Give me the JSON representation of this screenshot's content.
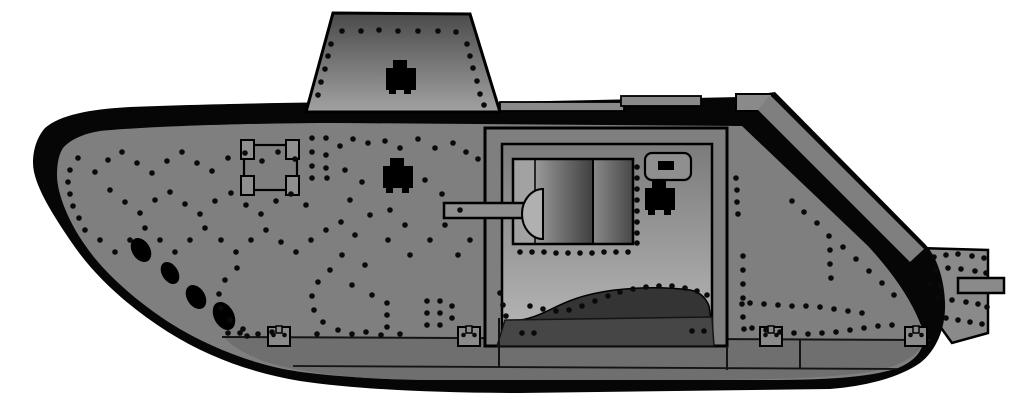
{
  "illustration": {
    "alt": "Side profile illustration of a World War One heavy tank with riveted armour plates, raised driver's cab, side sponson mounting a short gun, mud chutes and a full-length caterpillar track",
    "subject": "WWI heavy tank, left side view",
    "style": "flat vector drawing with rivet detail"
  },
  "canvas": {
    "width": 1024,
    "height": 410
  },
  "colors": {
    "background": "#ffffff",
    "outline": "#000000",
    "track": "#060606",
    "hull": "#7f7f7f",
    "hull_lower": "#6f6f6f",
    "roof": "#8a8a8a",
    "tail": "#8a8a8a",
    "cab_top": "#4a4a4a",
    "cab_bottom": "#a2a2a2",
    "sponson_top": "#7b7b7b",
    "sponson_bottom": "#b8b8b8",
    "gunbox_strip": "#a2a2a2",
    "gunbox_light": "#9a9a9a",
    "gunbox_dark": "#3f3f3f",
    "gunbox_right_light": "#8a8a8a",
    "gunbox_right_dark": "#474747",
    "barrel": "#8f8f8f",
    "mantlet": "#b0b0b0",
    "port": "#8f8f8f",
    "shadow": "#343434",
    "skirt_band": "#464646",
    "seam": "#141414",
    "rivet": "#0a0a0a",
    "detail": "#000000"
  },
  "rivet_radius": 2.8,
  "rivets": [
    [
      342,
      31
    ],
    [
      361,
      31
    ],
    [
      379,
      30
    ],
    [
      398,
      31
    ],
    [
      418,
      31
    ],
    [
      438,
      31
    ],
    [
      456,
      32
    ],
    [
      331,
      44
    ],
    [
      328,
      56
    ],
    [
      325,
      69
    ],
    [
      321,
      82
    ],
    [
      318,
      95
    ],
    [
      467,
      44
    ],
    [
      470,
      56
    ],
    [
      473,
      68
    ],
    [
      477,
      81
    ],
    [
      480,
      94
    ],
    [
      484,
      105
    ],
    [
      312,
      138
    ],
    [
      326,
      138
    ],
    [
      312,
      152
    ],
    [
      326,
      155
    ],
    [
      312,
      166
    ],
    [
      326,
      168
    ],
    [
      312,
      178
    ],
    [
      327,
      178
    ],
    [
      340,
      146
    ],
    [
      353,
      139
    ],
    [
      368,
      143
    ],
    [
      385,
      141
    ],
    [
      400,
      148
    ],
    [
      418,
      139
    ],
    [
      435,
      148
    ],
    [
      453,
      143
    ],
    [
      466,
      152
    ],
    [
      478,
      159
    ],
    [
      78,
      158
    ],
    [
      70,
      170
    ],
    [
      68,
      182
    ],
    [
      70,
      194
    ],
    [
      73,
      206
    ],
    [
      79,
      218
    ],
    [
      85,
      230
    ],
    [
      95,
      172
    ],
    [
      108,
      160
    ],
    [
      122,
      152
    ],
    [
      137,
      163
    ],
    [
      152,
      173
    ],
    [
      167,
      161
    ],
    [
      182,
      152
    ],
    [
      197,
      163
    ],
    [
      212,
      171
    ],
    [
      228,
      158
    ],
    [
      245,
      153
    ],
    [
      262,
      161
    ],
    [
      278,
      152
    ],
    [
      295,
      159
    ],
    [
      110,
      190
    ],
    [
      125,
      202
    ],
    [
      140,
      213
    ],
    [
      155,
      200
    ],
    [
      170,
      192
    ],
    [
      185,
      204
    ],
    [
      200,
      214
    ],
    [
      215,
      201
    ],
    [
      231,
      193
    ],
    [
      246,
      205
    ],
    [
      261,
      214
    ],
    [
      276,
      201
    ],
    [
      291,
      194
    ],
    [
      306,
      205
    ],
    [
      100,
      240
    ],
    [
      115,
      252
    ],
    [
      130,
      240
    ],
    [
      145,
      228
    ],
    [
      160,
      240
    ],
    [
      175,
      252
    ],
    [
      190,
      240
    ],
    [
      205,
      228
    ],
    [
      221,
      240
    ],
    [
      236,
      252
    ],
    [
      251,
      240
    ],
    [
      266,
      230
    ],
    [
      281,
      242
    ],
    [
      296,
      252
    ],
    [
      311,
      240
    ],
    [
      326,
      230
    ],
    [
      341,
      222
    ],
    [
      345,
      170
    ],
    [
      362,
      182
    ],
    [
      350,
      200
    ],
    [
      370,
      215
    ],
    [
      355,
      235
    ],
    [
      342,
      255
    ],
    [
      365,
      265
    ],
    [
      390,
      210
    ],
    [
      405,
      225
    ],
    [
      388,
      240
    ],
    [
      410,
      255
    ],
    [
      430,
      240
    ],
    [
      445,
      225
    ],
    [
      460,
      210
    ],
    [
      442,
      194
    ],
    [
      425,
      180
    ],
    [
      458,
      255
    ],
    [
      470,
      240
    ],
    [
      352,
      285
    ],
    [
      372,
      295
    ],
    [
      237,
      268
    ],
    [
      225,
      280
    ],
    [
      219,
      294
    ],
    [
      221,
      308
    ],
    [
      230,
      320
    ],
    [
      243,
      329
    ],
    [
      258,
      334
    ],
    [
      272,
      332
    ],
    [
      330,
      270
    ],
    [
      318,
      282
    ],
    [
      312,
      296
    ],
    [
      314,
      310
    ],
    [
      323,
      322
    ],
    [
      338,
      330
    ],
    [
      352,
      334
    ],
    [
      366,
      332
    ],
    [
      381,
      335
    ],
    [
      247,
      336
    ],
    [
      387,
      303
    ],
    [
      387,
      315
    ],
    [
      387,
      327
    ],
    [
      427,
      301
    ],
    [
      440,
      301
    ],
    [
      427,
      313
    ],
    [
      440,
      313
    ],
    [
      427,
      325
    ],
    [
      440,
      325
    ],
    [
      452,
      306
    ],
    [
      452,
      318
    ],
    [
      228,
      333
    ],
    [
      240,
      333
    ],
    [
      317,
      334
    ],
    [
      400,
      334
    ],
    [
      736,
      178
    ],
    [
      737,
      190
    ],
    [
      737,
      202
    ],
    [
      738,
      214
    ],
    [
      792,
      201
    ],
    [
      804,
      212
    ],
    [
      817,
      223
    ],
    [
      829,
      236
    ],
    [
      830,
      250
    ],
    [
      830,
      264
    ],
    [
      831,
      278
    ],
    [
      843,
      247
    ],
    [
      856,
      259
    ],
    [
      869,
      271
    ],
    [
      882,
      283
    ],
    [
      894,
      295
    ],
    [
      750,
      303
    ],
    [
      764,
      304
    ],
    [
      778,
      305
    ],
    [
      792,
      306
    ],
    [
      806,
      306
    ],
    [
      820,
      307
    ],
    [
      834,
      309
    ],
    [
      848,
      311
    ],
    [
      862,
      313
    ],
    [
      752,
      328
    ],
    [
      766,
      330
    ],
    [
      780,
      332
    ],
    [
      794,
      333
    ],
    [
      808,
      334
    ],
    [
      822,
      333
    ],
    [
      836,
      332
    ],
    [
      850,
      330
    ],
    [
      864,
      328
    ],
    [
      878,
      326
    ],
    [
      892,
      325
    ],
    [
      743,
      256
    ],
    [
      743,
      270
    ],
    [
      743,
      284
    ],
    [
      743,
      298
    ],
    [
      934,
      257
    ],
    [
      946,
      255
    ],
    [
      958,
      254
    ],
    [
      972,
      256
    ],
    [
      984,
      258
    ],
    [
      936,
      270
    ],
    [
      948,
      268
    ],
    [
      961,
      269
    ],
    [
      975,
      271
    ],
    [
      986,
      273
    ],
    [
      930,
      284
    ],
    [
      940,
      286
    ],
    [
      938,
      298
    ],
    [
      952,
      300
    ],
    [
      966,
      302
    ],
    [
      978,
      304
    ],
    [
      987,
      307
    ],
    [
      946,
      318
    ],
    [
      958,
      320
    ],
    [
      970,
      322
    ],
    [
      982,
      324
    ],
    [
      637,
      167
    ],
    [
      637,
      178
    ],
    [
      637,
      189
    ],
    [
      637,
      200
    ],
    [
      637,
      211
    ],
    [
      637,
      222
    ],
    [
      637,
      233
    ],
    [
      637,
      243
    ],
    [
      520,
      252
    ],
    [
      532,
      252
    ],
    [
      544,
      252
    ],
    [
      556,
      253
    ],
    [
      568,
      253
    ],
    [
      580,
      253
    ],
    [
      592,
      253
    ],
    [
      604,
      252
    ],
    [
      616,
      252
    ],
    [
      628,
      252
    ],
    [
      530,
      306
    ],
    [
      543,
      309
    ],
    [
      556,
      311
    ],
    [
      569,
      310
    ],
    [
      582,
      306
    ],
    [
      595,
      301
    ],
    [
      608,
      296
    ],
    [
      620,
      292
    ],
    [
      633,
      289
    ],
    [
      646,
      287
    ],
    [
      659,
      286
    ],
    [
      672,
      286
    ],
    [
      685,
      288
    ],
    [
      697,
      291
    ],
    [
      707,
      295
    ],
    [
      500,
      293
    ],
    [
      503,
      305
    ],
    [
      506,
      316
    ],
    [
      522,
      333
    ],
    [
      534,
      333
    ],
    [
      692,
      331
    ],
    [
      704,
      331
    ],
    [
      742,
      304
    ],
    [
      743,
      317
    ],
    [
      744,
      329
    ]
  ],
  "mud_chutes": [
    {
      "cx": 141,
      "cy": 250,
      "rx": 9,
      "ry": 13,
      "angle": -32
    },
    {
      "cx": 170,
      "cy": 273,
      "rx": 8,
      "ry": 12,
      "angle": -32
    },
    {
      "cx": 196,
      "cy": 297,
      "rx": 9,
      "ry": 13,
      "angle": -32
    },
    {
      "cx": 224,
      "cy": 316,
      "rx": 10,
      "ry": 15,
      "angle": -28
    }
  ],
  "track_brackets": {
    "y": 327,
    "w": 22,
    "h": 19,
    "xs": [
      268,
      458,
      760,
      905
    ]
  }
}
